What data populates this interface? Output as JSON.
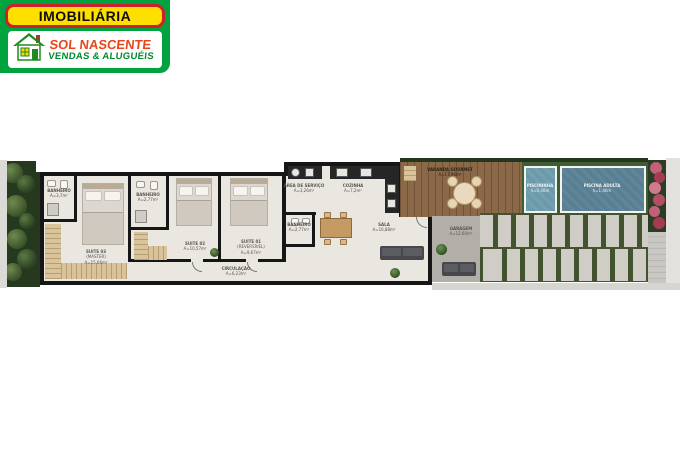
{
  "logo": {
    "line1": "IMOBILIÁRIA",
    "line2": "SOL NASCENTE",
    "line3": "VENDAS & ALUGUÉIS",
    "colors": {
      "background_green": "#00a33e",
      "banner_yellow": "#ffdf00",
      "banner_border_red": "#cf1f2e",
      "brand_red": "#e8471d",
      "services_green": "#008a2e"
    }
  },
  "plan": {
    "rooms": {
      "banheiro_master": {
        "name": "BANHEIRO",
        "area": "A=3,7m²"
      },
      "suite03": {
        "name": "SUITE 03",
        "sub": "(MASTER)",
        "area": "A=15,66m²"
      },
      "banheiro_suite": {
        "name": "BANHEIRO",
        "area": "A=2,77m²"
      },
      "suite02": {
        "name": "SUITE 02",
        "area": "A=10,57m²"
      },
      "suite01": {
        "name": "SUITE 01",
        "sub": "(REVERSÍVEL)",
        "area": "A=9,67m²"
      },
      "circulacao": {
        "name": "CIRCULAÇÃO",
        "area": "A=6,23m²"
      },
      "area_servico": {
        "name": "ÁREA DE SERVIÇO",
        "area": "A=3,26m²"
      },
      "cozinha": {
        "name": "COZINHA",
        "area": "A=7,2m²"
      },
      "banheiro_social": {
        "name": "BANHEIRO",
        "area": "A=2,77m²"
      },
      "sala": {
        "name": "SALA",
        "area": "A=16,88m²"
      },
      "varanda": {
        "name": "VARANDA GOURMET",
        "area": "A=17,96m²"
      },
      "garagem": {
        "name": "GARAGEM",
        "area": "A=12,60m²"
      },
      "piscininha": {
        "name": "PISCININHA",
        "area": "h=0,40m"
      },
      "piscina_adulta": {
        "name": "PISCINA ADULTA",
        "area": "h=1,40m"
      }
    },
    "colors": {
      "floor": "#eae7e1",
      "walls": "#161616",
      "wardrobe": "#d8c39a",
      "deck_wood": "#8a6848",
      "pool_water": "#587f93",
      "grass": "#3f5c33",
      "garden": "#26391f",
      "paver": "#d0cdc6",
      "shrub_pink": "#c2607a"
    }
  }
}
